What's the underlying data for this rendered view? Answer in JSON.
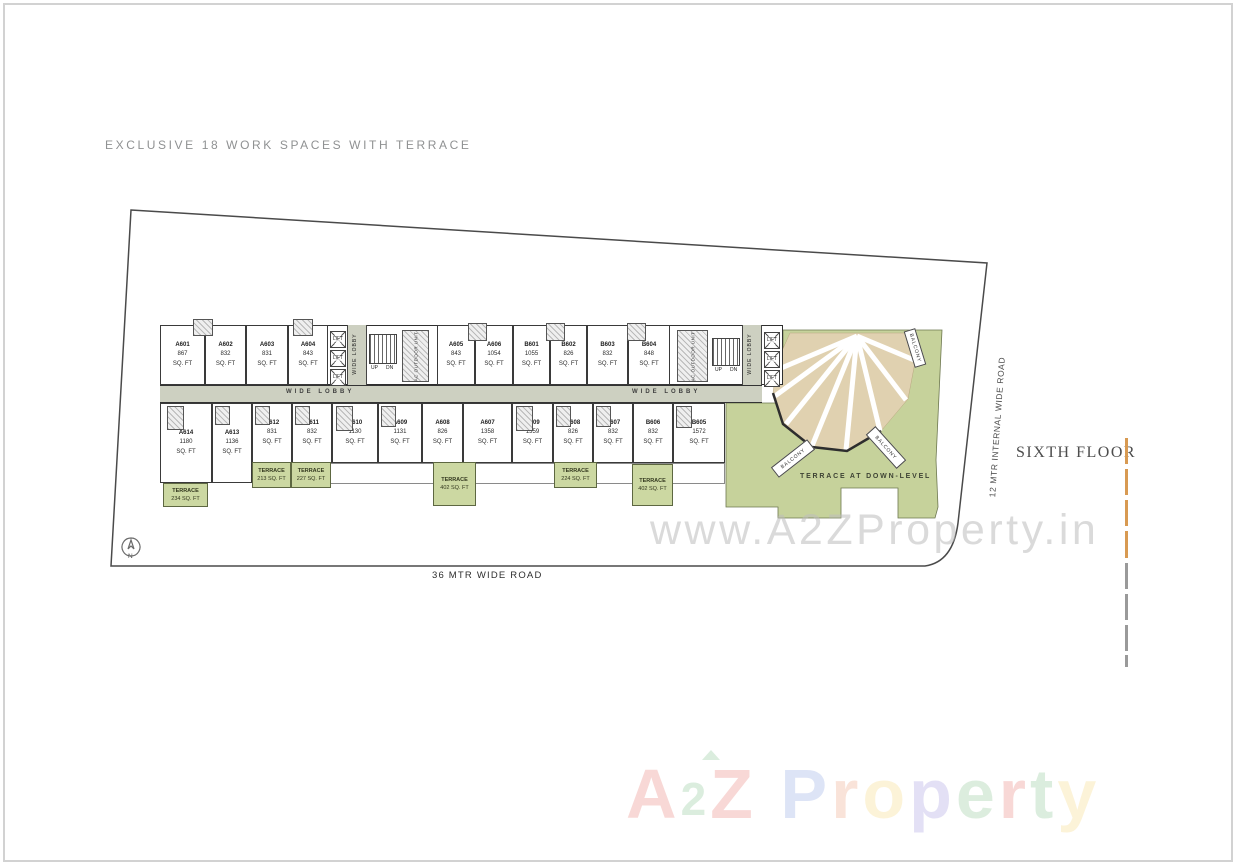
{
  "header": {
    "title": "EXCLUSIVE 18 WORK SPACES WITH TERRACE"
  },
  "floor": {
    "label": "SIXTH FLOOR"
  },
  "roads": {
    "bottom": "36 MTR WIDE ROAD",
    "right": "12 MTR INTERNAL WIDE ROAD"
  },
  "compass": {
    "label": "N"
  },
  "plan": {
    "lobby_label": "WIDE LOBBY",
    "lift_label": "LIFT",
    "stairs": {
      "up": "UP",
      "down": "DN"
    },
    "ac_label": "AC OUTDOOR UNIT",
    "balcony_label": "BALCONY",
    "terrace_down_label": "TERRACE AT DOWN-LEVEL",
    "sqft_suffix": "SQ. FT",
    "units_top": [
      {
        "id": "A601",
        "sqft": "867"
      },
      {
        "id": "A602",
        "sqft": "832"
      },
      {
        "id": "A603",
        "sqft": "831"
      },
      {
        "id": "A604",
        "sqft": "843"
      },
      {
        "id": "A605",
        "sqft": "843"
      },
      {
        "id": "A606",
        "sqft": "1054"
      },
      {
        "id": "B601",
        "sqft": "1055"
      },
      {
        "id": "B602",
        "sqft": "826"
      },
      {
        "id": "B603",
        "sqft": "832"
      },
      {
        "id": "B604",
        "sqft": "848"
      }
    ],
    "units_bottom": [
      {
        "id": "A614",
        "sqft": "1180"
      },
      {
        "id": "A613",
        "sqft": "1136"
      },
      {
        "id": "A612",
        "sqft": "831"
      },
      {
        "id": "A611",
        "sqft": "832"
      },
      {
        "id": "A610",
        "sqft": "1130"
      },
      {
        "id": "A609",
        "sqft": "1131"
      },
      {
        "id": "A608",
        "sqft": "826"
      },
      {
        "id": "A607",
        "sqft": "1358"
      },
      {
        "id": "B609",
        "sqft": "1359"
      },
      {
        "id": "B608",
        "sqft": "826"
      },
      {
        "id": "B607",
        "sqft": "832"
      },
      {
        "id": "B606",
        "sqft": "832"
      },
      {
        "id": "B605",
        "sqft": "1572"
      }
    ],
    "terraces": [
      {
        "label": "TERRACE",
        "area": "234 SQ. FT"
      },
      {
        "label": "TERRACE",
        "area": "213 SQ. FT"
      },
      {
        "label": "TERRACE",
        "area": "227 SQ. FT"
      },
      {
        "label": "TERRACE",
        "area": "402 SQ. FT"
      },
      {
        "label": "TERRACE",
        "area": "224 SQ. FT"
      },
      {
        "label": "TERRACE",
        "area": "402 SQ. FT"
      }
    ]
  },
  "watermarks": {
    "site_url": "www.A2ZProperty.in",
    "logo_letters": [
      {
        "ch": "A",
        "color": "#d93025"
      },
      {
        "ch": "2",
        "color": "#3b9e4e"
      },
      {
        "ch": "Z",
        "color": "#d93025"
      },
      {
        "ch": " ",
        "color": "#000000"
      },
      {
        "ch": "P",
        "color": "#4a6fd1"
      },
      {
        "ch": "r",
        "color": "#e06b33"
      },
      {
        "ch": "o",
        "color": "#efbf2f"
      },
      {
        "ch": "p",
        "color": "#6b5bc9"
      },
      {
        "ch": "e",
        "color": "#44a04c"
      },
      {
        "ch": "r",
        "color": "#d93025"
      },
      {
        "ch": "t",
        "color": "#3b9e4e"
      },
      {
        "ch": "y",
        "color": "#efbf2f"
      }
    ]
  },
  "colors": {
    "dash_orange": "#d89a52",
    "dash_gray": "#9a9a9a",
    "terrace_green": "#ccd8a2",
    "landscape_green": "#c6d29b",
    "lobby_gray": "#cdd0c1",
    "fan_tan": "#e0d1b0"
  }
}
